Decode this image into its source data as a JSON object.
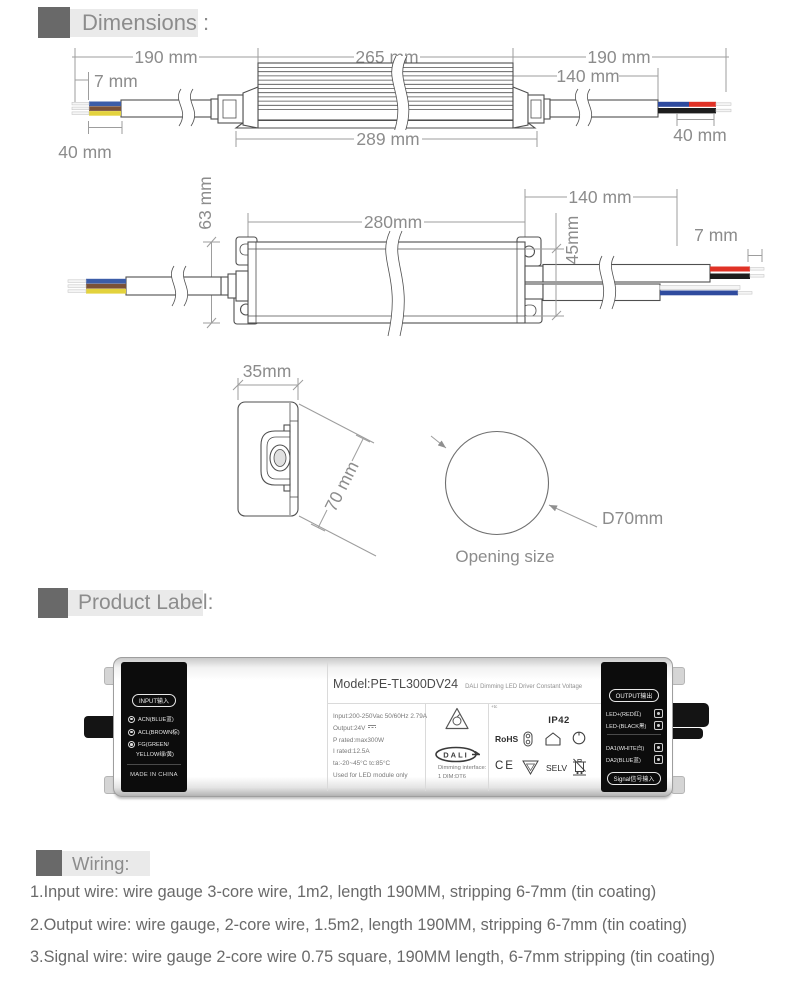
{
  "sections": {
    "dimensions": {
      "title": "Dimensions :"
    },
    "product_label": {
      "title": "Product Label:"
    },
    "wiring": {
      "title": "Wiring:"
    }
  },
  "drawings": {
    "side_view": {
      "dim_wire_left": "190 mm",
      "dim_strip_left": "7 mm",
      "dim_strip_len_left": "40 mm",
      "dim_body": "265 mm",
      "dim_body_flange": "289 mm",
      "dim_wire_right": "190 mm",
      "dim_cable_right": "140 mm",
      "dim_strip_len_right": "40 mm"
    },
    "top_view": {
      "dim_height": "63 mm",
      "dim_body": "280mm",
      "dim_cable": "140 mm",
      "dim_width": "45mm",
      "dim_strip": "7 mm"
    },
    "end_view": {
      "dim_width": "35mm",
      "dim_diag": "70 mm"
    },
    "opening": {
      "diameter": "D70mm",
      "caption": "Opening size"
    }
  },
  "label": {
    "input_panel": {
      "badge": "INPUT输入",
      "terminal_acn": "ACN(BLUE蓝)",
      "terminal_acl": "ACL(BROWN棕)",
      "terminal_fg_line1": "FG(GREEN/",
      "terminal_fg_line2": "YELLOW绿/黄)",
      "origin": "MADE IN CHINA"
    },
    "model": {
      "title": "Model:PE-TL300DV24",
      "subtitle": "DALI Dimming LED Driver Constant Voltage"
    },
    "specs": [
      "Input:200-250Vac 50/60Hz  2.79A",
      "Output:24V",
      "P rated:max300W",
      "I rated:12.5A",
      "ta:-20~45°C   tc:85°C",
      "Used for LED module only"
    ],
    "dali": {
      "logo": "DALI",
      "interface_line1": "Dimming interface:",
      "interface_line2": "1 DIM:DT6"
    },
    "certs": {
      "tc": "+tc",
      "ip": "IP42",
      "rohs": "RoHS",
      "ce": "CE",
      "selv": "SELV"
    },
    "output_panel": {
      "badge": "OUTPUT输出",
      "led_plus": "LED+(RED红)",
      "led_minus": "LED-(BLACK黑)",
      "da1": "DA1(WHITE白)",
      "da2": "DA2(BLUE蓝)",
      "signal_badge": "Signal信号输入"
    },
    "icons": [
      "quality-triangle-mark",
      "dali-logo",
      "rohs-mark",
      "fuse-mark",
      "indoor-use-mark",
      "circle-mark",
      "ce-mark",
      "vde-triangle-mark",
      "selv-mark",
      "weee-bin-mark"
    ]
  },
  "wiring": {
    "items": [
      "1.Input wire: wire gauge 3-core wire, 1m2, length 190MM, stripping 6-7mm (tin coating)",
      "2.Output wire: wire gauge, 2-core wire, 1.5m2, length 190MM, stripping 6-7mm (tin coating)",
      "3.Signal wire: wire gauge 2-core wire 0.75 square, 190MM length, 6-7mm stripping (tin coating)"
    ]
  },
  "colors": {
    "header_square": "#696969",
    "header_bar": "#eaeaea",
    "wire_blue": "#3c5da8",
    "wire_brown": "#7a5138",
    "wire_yellow": "#e3d23d",
    "wire_red": "#e03226",
    "wire_black": "#1d1d1d",
    "outline": "#4f4f4f",
    "dimension": "#9d9d9d"
  }
}
